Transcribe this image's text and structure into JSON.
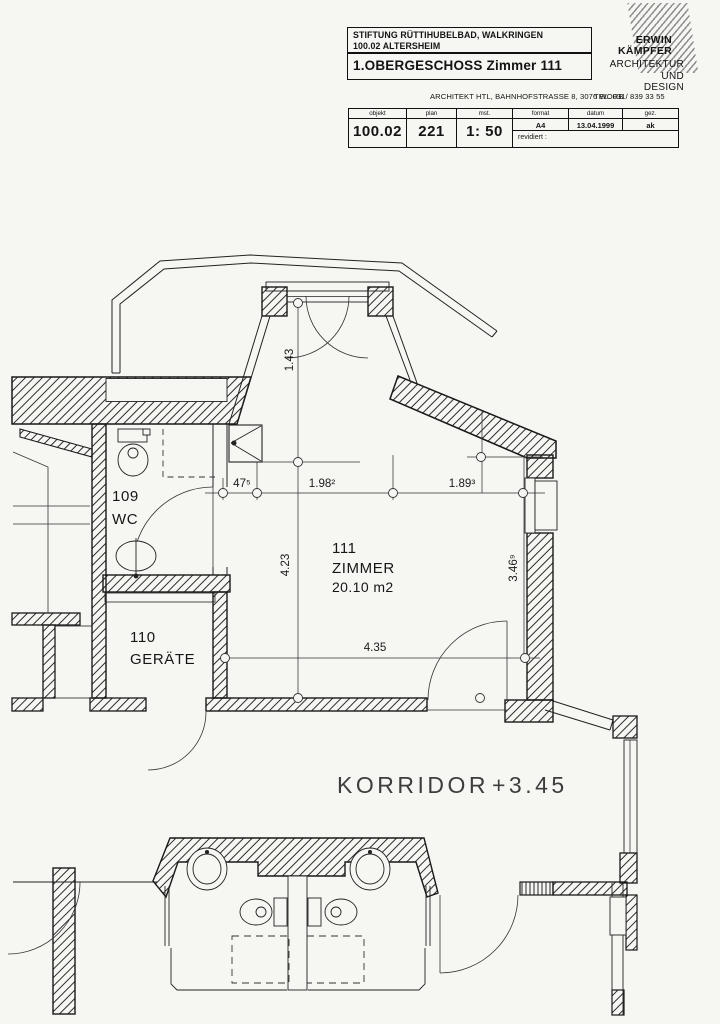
{
  "title_block": {
    "project_line1": "STIFTUNG RÜTTIHUBELBAD, WALKRINGEN",
    "project_line2": "100.02 ALTERSHEIM",
    "drawing_title": "1.OBERGESCHOSS Zimmer 111",
    "architect": {
      "name_line1": "ERWIN",
      "name_line2": "KÄMPFER",
      "field_line1": "ARCHITEKTUR",
      "field_line2": "UND",
      "field_line3": "DESIGN",
      "address": "ARCHITEKT HTL, BAHNHOFSTRASSE 8, 3076 WORB",
      "phone": "TEL. 031/ 839 33 55"
    },
    "info_table": {
      "headers": {
        "objekt": "objekt",
        "plan": "plan",
        "scale": "mst.",
        "format": "format",
        "date": "datum",
        "drawn": "gez."
      },
      "values": {
        "objekt": "100.02",
        "plan": "221",
        "scale": "1: 50",
        "format": "A4",
        "date": "13.04.1999",
        "drawn": "ak"
      },
      "revised_label": "revidiert :"
    }
  },
  "plan": {
    "rooms": {
      "wc": {
        "number": "109",
        "name": "WC"
      },
      "geraete": {
        "number": "110",
        "name": "GERÄTE"
      },
      "zimmer": {
        "number": "111",
        "name": "ZIMMER",
        "area": "20.10 m2"
      }
    },
    "corridor": {
      "label": "KORRIDOR",
      "level": "+3.45"
    },
    "dimensions": {
      "bay_depth": "1.43",
      "chain_a": "47⁵",
      "chain_b": "1.98²",
      "chain_c": "1.89³",
      "depth_left": "4.23",
      "depth_right": "3.46⁹",
      "width_bottom": "4.35"
    }
  }
}
